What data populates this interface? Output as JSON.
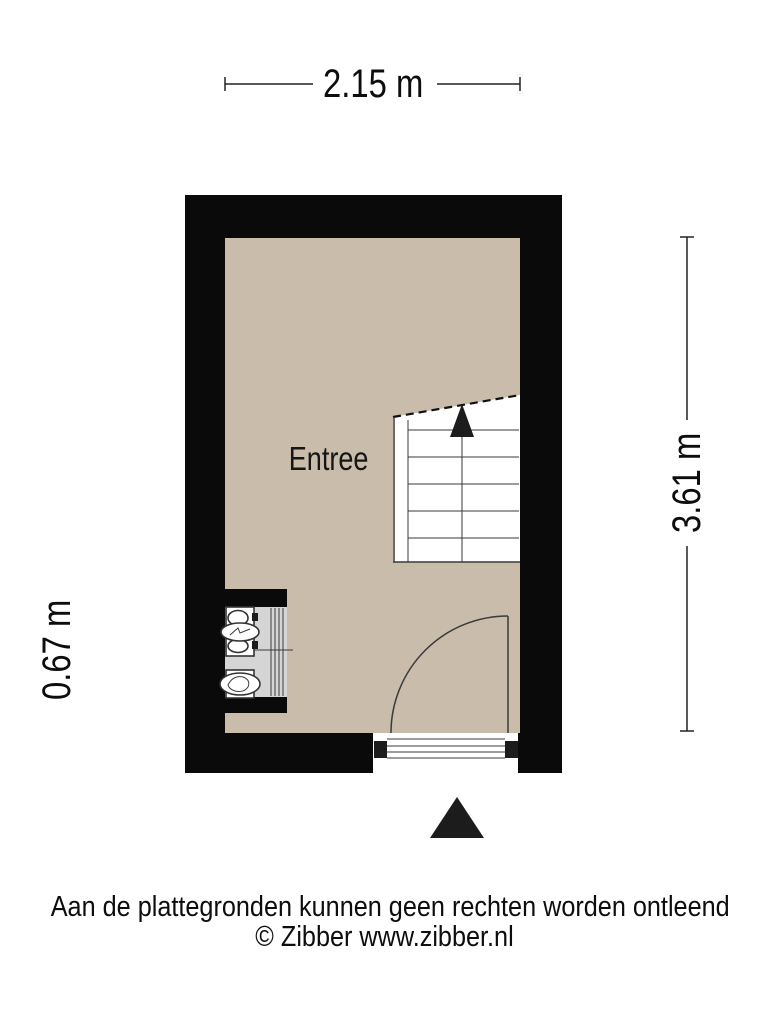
{
  "plan": {
    "room_label": "Entree",
    "symbols": [
      "staircase-up",
      "entry-door-swing",
      "sink",
      "toilet",
      "radiator",
      "entrance-arrow"
    ]
  },
  "dimensions": {
    "width_label": "2.15 m",
    "height_label": "3.61 m",
    "niche_label": "0.67 m"
  },
  "footer": {
    "disclaimer": "Aan de plattegronden kunnen geen rechten worden ontleend",
    "copyright": "© Zibber www.zibber.nl"
  },
  "colors": {
    "floor": "#c9bcab",
    "wall": "#0a0a0a",
    "fixture-bg": "#d5d5d5",
    "line": "#3a3a3a",
    "text": "#111111"
  }
}
